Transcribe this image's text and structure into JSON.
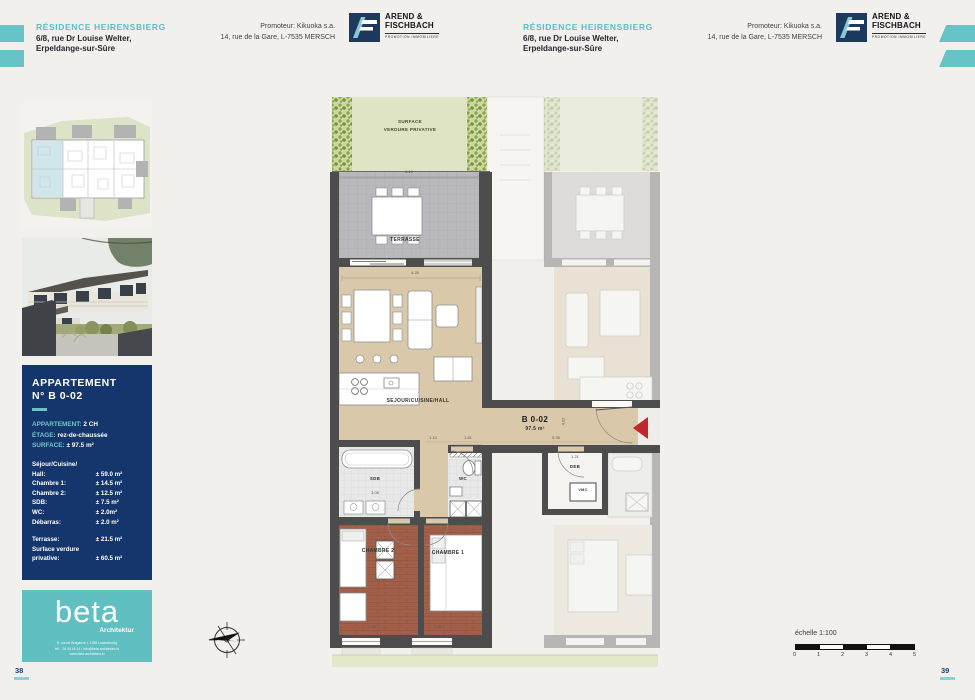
{
  "header": {
    "title": "RÉSIDENCE HEIRENSBIERG",
    "address_line1": "6/8, rue Dr Louise Welter,",
    "address_line2": "Erpeldange-sur-Sûre",
    "promoter_line1": "Promoteur: Kikuoka s.a.",
    "promoter_line2": "14, rue de la Gare, L-7535 MERSCH",
    "logo_name_line1": "AREND &",
    "logo_name_line2": "FISCHBACH",
    "logo_tagline": "PROMOTION IMMOBILIERE"
  },
  "pages": {
    "left_number": "38",
    "right_number": "39"
  },
  "info_panel": {
    "title_line1": "APPARTEMENT",
    "title_line2": "N° B 0-02",
    "spec_apartment_label": "APPARTEMENT:",
    "spec_apartment_value": "2 CH",
    "spec_floor_label": "ÉTAGE:",
    "spec_floor_value": "rez-de-chaussée",
    "spec_surface_label": "SURFACE:",
    "spec_surface_value": "± 97.5 m²",
    "rooms": [
      {
        "label": "Séjour/Cuisine/",
        "value": ""
      },
      {
        "label": "Hall:",
        "value": "± 59.0 m²"
      },
      {
        "label": "Chambre 1:",
        "value": "± 14.5 m²"
      },
      {
        "label": "Chambre 2:",
        "value": "± 12.5 m²"
      },
      {
        "label": "SDB:",
        "value": "± 7.5 m²"
      },
      {
        "label": "WC:",
        "value": "± 2.0m²"
      },
      {
        "label": "Débarras:",
        "value": "± 2.0 m²"
      },
      {
        "label": "Terrasse:",
        "value": "± 21.5 m²"
      },
      {
        "label": "Surface verdure",
        "value": ""
      },
      {
        "label": "privative:",
        "value": "± 60.5 m²"
      }
    ]
  },
  "architect": {
    "name": "beta",
    "subtitle": "Architektur",
    "address_line": "6, rue de Bragance L-1255 Luxembourg",
    "contact_line": "tél. : 26 09 44 14 / info@beta-architektur.lu",
    "web_line": "www.beta-architektur.lu"
  },
  "plan": {
    "garden_label_line1": "SURFACE",
    "garden_label_line2": "VERDURE PRIVATIVE",
    "terrace_label": "TERRASSE",
    "living_label": "SEJOUR/CUISINE/HALL",
    "unit_label": "B 0-02",
    "unit_area": "97.5 m²",
    "bedroom1_label": "CHAMBRE 1",
    "bedroom2_label": "CHAMBRE 2",
    "bath_label": "SDB",
    "wc_label": "WC",
    "storage_label": "DEB",
    "vent_label": "VMC",
    "dims": {
      "terrace_width": "8.10",
      "living_width": "4.25",
      "hall_a": "1.10",
      "hall_b": "1.81",
      "hall_c": "5.38",
      "hall_depth": "4.52",
      "bath_width": "3.08",
      "storage_width": "1.21",
      "bedroom2_width": "2.25",
      "bedroom1_width": "2.90"
    }
  },
  "scale_bar": {
    "label": "échelle 1:100",
    "ticks": [
      "0",
      "1",
      "2",
      "3",
      "4",
      "5"
    ]
  },
  "colors": {
    "accent_teal": "#68c3c7",
    "navy": "#15356d",
    "entrance_red": "#c2272d",
    "living_floor": "#d9c8a9",
    "bedroom_floor": "#a2604a",
    "terrace_gray": "#b9b9bd",
    "garden_green": "#dfe5c4"
  }
}
